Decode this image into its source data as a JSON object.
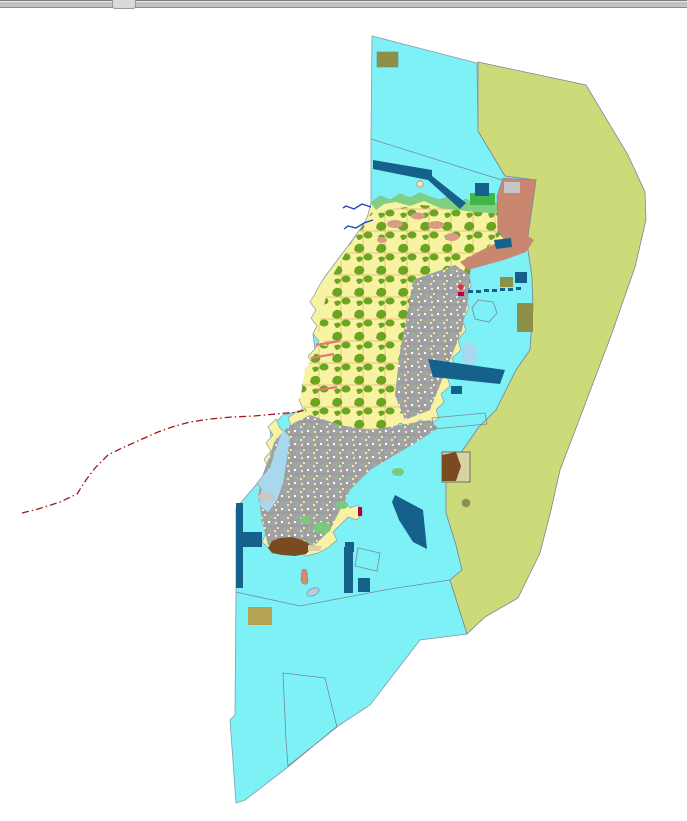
{
  "colors": {
    "sea": "#7DF1F5",
    "buffer": "#CDDA7A",
    "island_base": "#F8F3A2",
    "forest": "#6AA51F",
    "coast_green": "#7FD080",
    "bright_green": "#41B649",
    "patch_green": "#7CC87C",
    "urban": "#A2A2A6",
    "salmon": "#C9876F",
    "salmon_light": "#D99B85",
    "navy": "#16608C",
    "khaki_dark": "#8F9048",
    "khaki_light": "#B3A352",
    "brown": "#7A4B21",
    "tan": "#D9D2A6",
    "pale_blue": "#A8D8EE",
    "gray_patch": "#CFC5C5",
    "inner_gray": "#C6C6C6",
    "magenta": "#B1004E",
    "route_red": "#A01818",
    "pier_pink": "#E07878",
    "river_blue": "#2244BB",
    "outline": "#8899AA",
    "thin_line": "#778899",
    "red_dot": "#E03030",
    "islet_gray": "#B9CCD9",
    "islet_salmon": "#D98B66",
    "parcel_line": "#DFAF72",
    "urban_line": "#8E8E92",
    "speck_yellow": "#EFE9A0",
    "speck_white": "#FFFFFF",
    "symbol_cream": "#F5E6C0",
    "border_dark": "#555555"
  }
}
